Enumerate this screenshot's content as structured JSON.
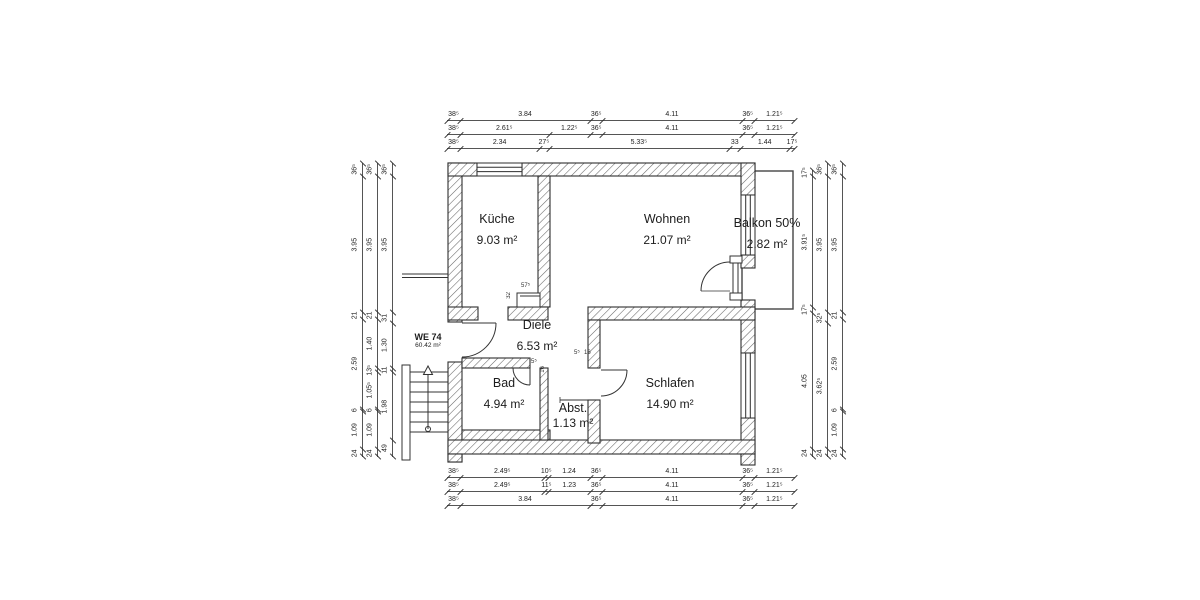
{
  "unit_label": {
    "id": "WE 74",
    "area": "60.42 m²"
  },
  "rooms": {
    "kueche": {
      "name": "Küche",
      "area": "9.03 m²"
    },
    "wohnen": {
      "name": "Wohnen",
      "area": "21.07 m²"
    },
    "balkon": {
      "name": "Balkon 50%",
      "area": "2.82 m²"
    },
    "diele": {
      "name": "Diele",
      "area": "6.53 m²"
    },
    "bad": {
      "name": "Bad",
      "area": "4.94 m²"
    },
    "abst": {
      "name": "Abst.",
      "area": "1.13 m²"
    },
    "schlafen": {
      "name": "Schlafen",
      "area": "14.90 m²"
    }
  },
  "dims": {
    "top": [
      [
        "38⁵",
        "3.84",
        "36⁵",
        "4.11",
        "36⁵",
        "1.21⁵"
      ],
      [
        "38⁵",
        "2.61⁵",
        "1.22⁵",
        "36⁵",
        "4.11",
        "36⁵",
        "1.21⁵"
      ],
      [
        "38⁵",
        "2.34",
        "27⁵",
        "5.33⁵",
        "33",
        "1.44",
        "17⁵"
      ]
    ],
    "bottom": [
      [
        "38⁵",
        "2.49⁵",
        "10⁵",
        "1.24",
        "36⁵",
        "4.11",
        "36⁵",
        "1.21⁵"
      ],
      [
        "38⁵",
        "2.49⁵",
        "11⁵",
        "1.23",
        "36⁵",
        "4.11",
        "36⁵",
        "1.21⁵"
      ],
      [
        "38⁵",
        "3.84",
        "36⁵",
        "4.11",
        "36⁵",
        "1.21⁵"
      ]
    ],
    "left": [
      [
        "36⁵",
        "3.95",
        "21",
        "2.59",
        "6",
        "1.09",
        "24"
      ],
      [
        "36⁵",
        "3.95",
        "21",
        "1.40",
        "13⁵",
        "1.05⁵",
        "6",
        "1.09",
        "24"
      ],
      [
        "36⁵",
        "3.95",
        "31",
        "1.30",
        "11",
        "1.98",
        "49"
      ]
    ],
    "right": [
      [
        "17⁵",
        "3.91⁵",
        "17⁵",
        "4.05",
        "24"
      ],
      [
        "36⁵",
        "3.95",
        "32⁵",
        "3.62⁵",
        "24"
      ],
      [
        "36⁵",
        "3.95",
        "21",
        "2.59",
        "6",
        "1.09",
        "24"
      ]
    ]
  },
  "detail_dims": {
    "niche_w": "57⁵",
    "niche_h": "32",
    "bad_door_w": "5⁵",
    "bad_door_j": "16",
    "schlafen_door_w": "5⁵",
    "schlafen_door_j": "16"
  },
  "colors": {
    "wall_line": "#2e2e2e",
    "hatch": "#666666",
    "thin_line": "#444444",
    "text": "#1c1c1c",
    "dim_text": "#222222",
    "background": "#ffffff"
  }
}
